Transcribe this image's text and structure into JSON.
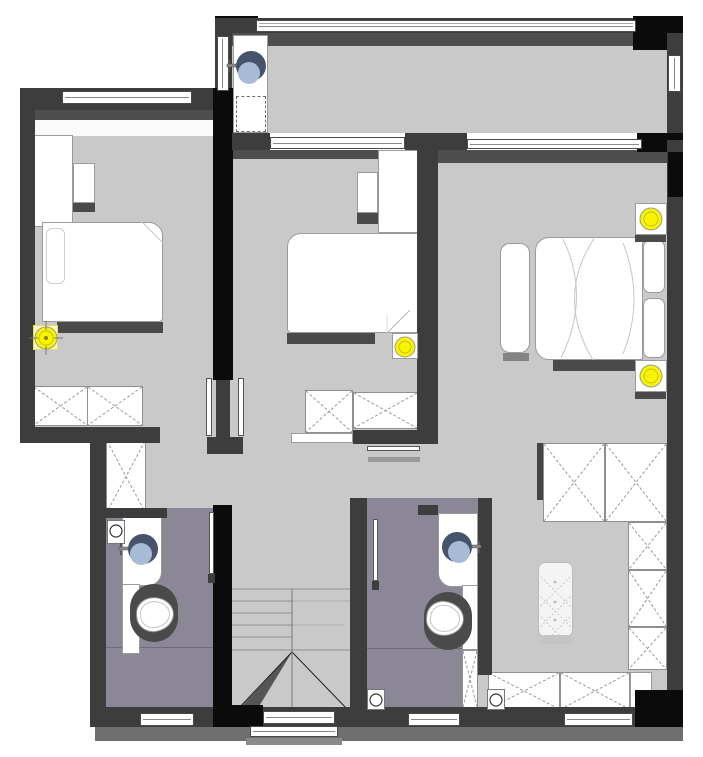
{
  "meta": {
    "title": "Residential upper-floor plan (rendered drawing)",
    "canvas": {
      "width": 703,
      "height": 757
    }
  },
  "palette": {
    "wall": "#3d3d3d",
    "wall_black": "#0b0b0b",
    "floor_gray": "#c9c9c9",
    "inner_band": "#4e4e4e",
    "bathroom_floor": "#8b8796",
    "furniture_white": "#ffffff",
    "furniture_outline": "#9b9b9b",
    "cast_shadow": "#4a4a4a",
    "ground_shadow": "#6f6f6f",
    "light_yellow": "#f8f400",
    "light_ring": "#c9c000",
    "basin_dark": "#47536a",
    "basin_light": "#a7bad6",
    "window_border": "#4a4a4a"
  },
  "rooms": [
    {
      "id": "laundry-balcony",
      "note": "top strip room with wash basin and machine position"
    },
    {
      "id": "bedroom-1",
      "note": "top-left bedroom"
    },
    {
      "id": "bedroom-2",
      "note": "middle bedroom"
    },
    {
      "id": "master-bedroom",
      "note": "right bedroom"
    },
    {
      "id": "hallway",
      "note": "central circulation"
    },
    {
      "id": "bathroom-1",
      "note": "left of staircase"
    },
    {
      "id": "bathroom-2",
      "note": "right of staircase"
    },
    {
      "id": "staircase",
      "note": "center-bottom with break line"
    },
    {
      "id": "dressing-area",
      "note": "bottom-right with rug and cabinets"
    }
  ],
  "fixtures": {
    "ceiling_lights": [
      {
        "room": "bedroom-1",
        "x": 46,
        "y": 338,
        "r": 11,
        "crosshair": true,
        "plate": {
          "x": 33,
          "y": 325,
          "w": 25,
          "h": 25,
          "glow": true
        }
      },
      {
        "room": "bedroom-2",
        "x": 405,
        "y": 347,
        "r": 10,
        "crosshair": false,
        "plate": {
          "x": 392,
          "y": 333,
          "w": 26,
          "h": 26,
          "glow": false
        }
      },
      {
        "room": "master-bedroom",
        "x": 651,
        "y": 219,
        "r": 11,
        "crosshair": false,
        "plate": {
          "x": 635,
          "y": 203,
          "w": 32,
          "h": 32,
          "glow": false
        }
      },
      {
        "room": "master-bedroom",
        "x": 651,
        "y": 376,
        "r": 11,
        "crosshair": false,
        "plate": {
          "x": 635,
          "y": 360,
          "w": 32,
          "h": 32,
          "glow": false
        }
      }
    ],
    "floor_drains": [
      {
        "room": "bathroom-1",
        "x": 116,
        "y": 531,
        "plate": {
          "x": 107,
          "y": 520,
          "w": 18,
          "h": 24
        }
      },
      {
        "room": "bathroom-2",
        "x": 376,
        "y": 700,
        "plate": {
          "x": 367,
          "y": 689,
          "w": 18,
          "h": 21
        }
      },
      {
        "room": "dressing-area",
        "x": 496,
        "y": 700,
        "plate": {
          "x": 487,
          "y": 689,
          "w": 18,
          "h": 21
        }
      }
    ],
    "wash_basins": [
      {
        "room": "laundry-balcony",
        "x": 251,
        "y": 66,
        "lx": 249,
        "ly": 73,
        "faucet": "left"
      },
      {
        "room": "bathroom-1",
        "x": 143,
        "y": 549,
        "lx": 141,
        "ly": 554,
        "faucet": "left"
      },
      {
        "room": "bathroom-2",
        "x": 457,
        "y": 547,
        "lx": 459,
        "ly": 552,
        "faucet": "right"
      }
    ],
    "inventory": {
      "beds": 3,
      "toilets": 2,
      "wardrobe_x_cells": 10,
      "windows": 10,
      "staircases": 1,
      "rugs": 1
    }
  }
}
